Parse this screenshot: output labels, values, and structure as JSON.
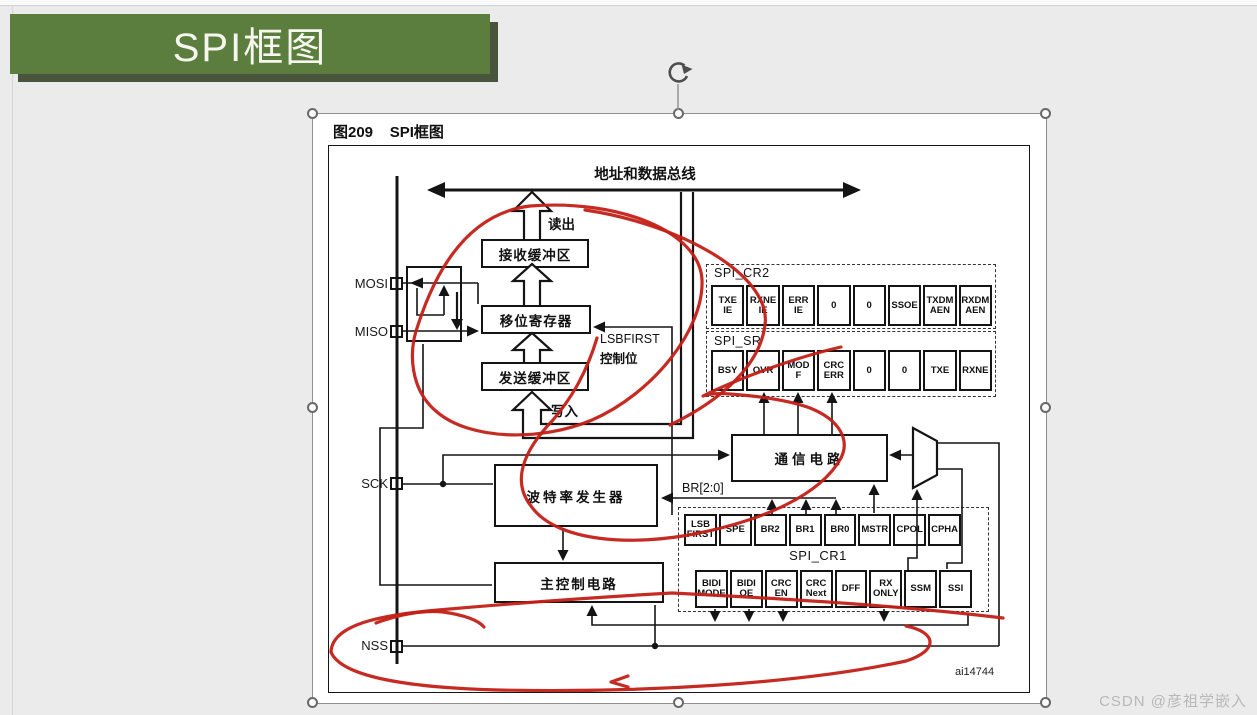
{
  "banner": {
    "title": "SPI框图"
  },
  "watermark": "CSDN @彦祖学嵌入",
  "figure": {
    "caption": "图209    SPI框图",
    "credit": "ai14744",
    "bus_label": "地址和数据总线",
    "read_label": "读出",
    "write_label": "写入",
    "lsbfirst_label": "LSBFIRST",
    "lsbfirst_label2": "控制位",
    "br_label": "BR[2:0]",
    "mux": {
      "in0": "0",
      "in1": "1"
    },
    "pins": {
      "mosi": "MOSI",
      "miso": "MISO",
      "sck": "SCK",
      "nss": "NSS"
    },
    "blocks": {
      "rx_buffer": "接收缓冲区",
      "shift_register": "移位寄存器",
      "tx_buffer": "发送缓冲区",
      "baud_gen": "波特率发生器",
      "comm_circuit": "通信电路",
      "main_ctrl": "主控制电路"
    },
    "registers": {
      "cr2": {
        "name": "SPI_CR2",
        "bits": [
          "TXE IE",
          "RXNE IE",
          "ERR IE",
          "0",
          "0",
          "SSOE",
          "TXDM AEN",
          "RXDM AEN"
        ]
      },
      "sr": {
        "name": "SPI_SR",
        "bits": [
          "BSY",
          "OVR",
          "MOD F",
          "CRC ERR",
          "0",
          "0",
          "TXE",
          "RXNE"
        ]
      },
      "cr1": {
        "name": "SPI_CR1",
        "bits_row1": [
          "LSB FIRST",
          "SPE",
          "BR2",
          "BR1",
          "BR0",
          "MSTR",
          "CPOL",
          "CPHA"
        ],
        "bits_row2": [
          "BIDI MODE",
          "BIDI OE",
          "CRC EN",
          "CRC Next",
          "DFF",
          "RX ONLY",
          "SSM",
          "SSI"
        ]
      }
    }
  },
  "colors": {
    "banner_green": "#5b7e3e",
    "annotation_red": "#c32017"
  }
}
